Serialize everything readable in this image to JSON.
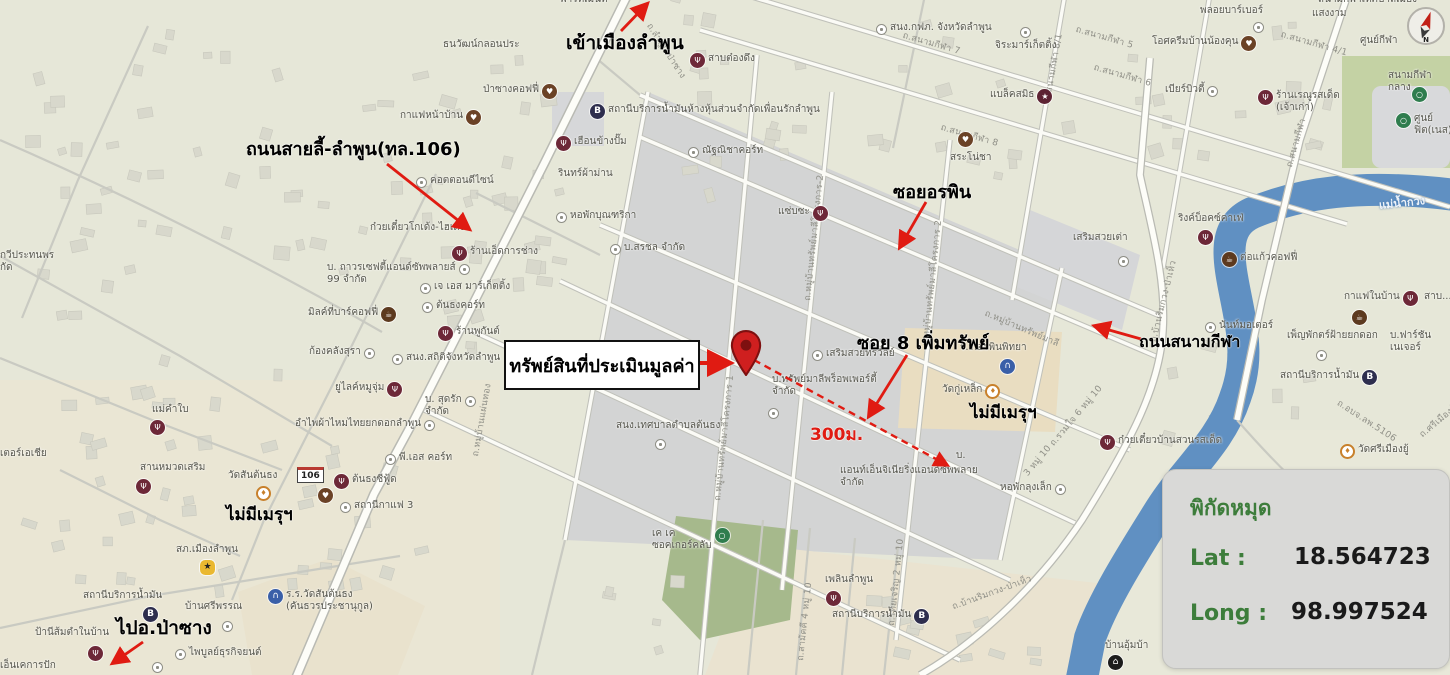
{
  "panel": {
    "title": "พิกัดหมุด",
    "lat_label": "Lat :",
    "lat_value": "18.564723",
    "long_label": "Long :",
    "long_value": "98.997524"
  },
  "property_box": {
    "label": "ทรัพย์สินที่ประเมินมูลค่า"
  },
  "colors": {
    "annotation_red": "#e01b12",
    "panel_green": "#3d7d3b",
    "pin_red": "#cf1f1f",
    "river_blue": "#6090c2"
  },
  "map": {
    "shield": {
      "t": "106"
    },
    "river_label": {
      "t": "แม่น้ำกวง",
      "x": 1378,
      "y": 196,
      "r": -6
    },
    "compass_label": "N",
    "pin": {
      "x": 746,
      "y": 375
    },
    "annotations": [
      {
        "t": "เข้าเมืองลำพูน",
        "x": 566,
        "y": 28,
        "s": 19
      },
      {
        "t": "ถนนสายลี้-ลำพูน(ทล.106)",
        "x": 246,
        "y": 134,
        "s": 18
      },
      {
        "t": "ซอยอรพิน",
        "x": 893,
        "y": 177,
        "s": 18
      },
      {
        "t": "ซอย 8 เพิ่มทรัพย์",
        "x": 857,
        "y": 328,
        "s": 18
      },
      {
        "t": "ไม่มีเมรุฯ",
        "x": 970,
        "y": 399,
        "s": 17
      },
      {
        "t": "ถนนสนามกีฬา",
        "x": 1139,
        "y": 330,
        "s": 16
      },
      {
        "t": "ไม่มีเมรุฯ",
        "x": 226,
        "y": 501,
        "s": 17
      },
      {
        "t": "ไปอ.ป่าซาง",
        "x": 116,
        "y": 613,
        "s": 19
      },
      {
        "t": "300ม.",
        "x": 810,
        "y": 421,
        "s": 17,
        "c": "#e01b12"
      }
    ],
    "arrows": [
      {
        "x1": 696,
        "y1": 363,
        "x2": 729,
        "y2": 363,
        "w": 4
      },
      {
        "x1": 754,
        "y1": 360,
        "x2": 947,
        "y2": 465,
        "w": 2.4,
        "dash": "7 5"
      },
      {
        "x1": 907,
        "y1": 355,
        "x2": 869,
        "y2": 416,
        "w": 2.8
      },
      {
        "x1": 926,
        "y1": 202,
        "x2": 900,
        "y2": 247,
        "w": 2.8
      },
      {
        "x1": 621,
        "y1": 31,
        "x2": 647,
        "y2": 4,
        "w": 2.8
      },
      {
        "x1": 387,
        "y1": 164,
        "x2": 469,
        "y2": 229,
        "w": 2.8
      },
      {
        "x1": 1141,
        "y1": 339,
        "x2": 1095,
        "y2": 326,
        "w": 2.8
      },
      {
        "x1": 143,
        "y1": 642,
        "x2": 113,
        "y2": 663,
        "w": 2.8
      }
    ],
    "road_labels": [
      {
        "t": "ถ.ลำพูน-ป่าซาง",
        "x": 655,
        "y": 20,
        "r": 57
      },
      {
        "t": "ถ.สนามกีฬา 7",
        "x": 905,
        "y": 28,
        "r": 16
      },
      {
        "t": "ถ.สนามกีฬา 5",
        "x": 1078,
        "y": 22,
        "r": 16
      },
      {
        "t": "ถ.สนามกีฬา 6",
        "x": 1096,
        "y": 60,
        "r": 16
      },
      {
        "t": "ถ.สนามกีฬา 8",
        "x": 943,
        "y": 120,
        "r": 16
      },
      {
        "t": "ถ.สนามกีฬา 8/1",
        "x": 1040,
        "y": 100,
        "r": -80
      },
      {
        "t": "ถ.สนามกีฬา 4/1",
        "x": 1283,
        "y": 27,
        "r": 16
      },
      {
        "t": "ถ.สนามกีฬา",
        "x": 1282,
        "y": 165,
        "r": -74
      },
      {
        "t": "ถ.หมู่บ้านทรัพย์มาลีโครงการ-2",
        "x": 800,
        "y": 300,
        "r": -84
      },
      {
        "t": "ถ.หมู่บ้านทรัพย์มาลีโครงการ 2",
        "x": 918,
        "y": 345,
        "r": -84
      },
      {
        "t": "ถ.หมู่บ้านทรัพย์มาลีโครงการ 1",
        "x": 710,
        "y": 500,
        "r": -84
      },
      {
        "t": "ถ.หมู่บ้านทรัพย์มาลี",
        "x": 988,
        "y": 306,
        "r": 23
      },
      {
        "t": "ถ.หมู่บ้านแผ่นทอง",
        "x": 468,
        "y": 455,
        "r": -80
      },
      {
        "t": "ถ.บ้านริมกวง-ป่าเห็ว",
        "x": 1146,
        "y": 340,
        "r": -76
      },
      {
        "t": "ถ.บ้านริมกวง-ป่าเห็ว",
        "x": 950,
        "y": 600,
        "r": -20
      },
      {
        "t": "ถ.รวมใจ 6 หมู่ 10",
        "x": 1046,
        "y": 440,
        "r": -50
      },
      {
        "t": "3 หมู่ 10",
        "x": 1020,
        "y": 470,
        "r": -50
      },
      {
        "t": "ถ.อบจ.ลพ.5106",
        "x": 1342,
        "y": 396,
        "r": 33
      },
      {
        "t": "ถ.สามัคคี 4 หมู่ 10",
        "x": 793,
        "y": 660,
        "r": -84
      },
      {
        "t": "ถ.ไทยเจริญ 2 หมู่ 10",
        "x": 884,
        "y": 625,
        "r": -84
      },
      {
        "t": "ถ.ศรีเมืองยู้ 2",
        "x": 1416,
        "y": 430,
        "r": -40
      }
    ],
    "pois": [
      {
        "t": "พาร์ทเมนท์",
        "x": 560,
        "y": -6
      },
      {
        "t": "สนง.กฟภ. จังหวัดลำพูน",
        "x": 876,
        "y": 22,
        "i": "generic"
      },
      {
        "t": "ธนวัฒน์กลอนประ",
        "x": 443,
        "y": 39
      },
      {
        "t": "สาบต๋องดึง",
        "x": 690,
        "y": 53,
        "i": "restaurant"
      },
      {
        "t": "ป่าซางคอฟฟี่",
        "x": 483,
        "y": 84,
        "i": "cafe",
        "ir": 1
      },
      {
        "t": "กาแฟหน้าบ้าน",
        "x": 400,
        "y": 110,
        "i": "cafe",
        "ir": 1
      },
      {
        "t": "สถานีบริการน้ำมันห้างหุ้นส่วนจำกัดเพื่อนรักลำพูน",
        "x": 590,
        "y": 104,
        "i": "fuel"
      },
      {
        "t": "เฮือนข้างปั๊ม",
        "x": 556,
        "y": 136,
        "i": "restaurant"
      },
      {
        "t": "ณัฐณิชาคอร์ท",
        "x": 688,
        "y": 145,
        "i": "generic"
      },
      {
        "t": "รินทร์ผ้าม่าน",
        "x": 558,
        "y": 168
      },
      {
        "t": "คอตตอนดีไซน์",
        "x": 416,
        "y": 175,
        "i": "generic"
      },
      {
        "t": "หอพักบุณฑริกา",
        "x": 556,
        "y": 210,
        "i": "generic"
      },
      {
        "t": "แซ่บซะ",
        "x": 778,
        "y": 206,
        "i": "restaurant",
        "ir": 1
      },
      {
        "t": "ก๋วยเตี๋ยวโกเด้ง-ไฮเด้ง",
        "x": 370,
        "y": 222
      },
      {
        "t": "ร้านเอ็ดการช่าง",
        "x": 452,
        "y": 246,
        "i": "restaurant"
      },
      {
        "t": "บ. ถาวรเซฟตี้แอนด์ซัพพลายส์\n99 จำกัด",
        "x": 327,
        "y": 262,
        "i": "generic",
        "ir": 1
      },
      {
        "t": "เจ เอส มาร์เก็ตติ้ง",
        "x": 420,
        "y": 281,
        "i": "generic"
      },
      {
        "t": "ต้นธงคอร์ท",
        "x": 422,
        "y": 300,
        "i": "generic"
      },
      {
        "t": "มิลค์ที่บาร์คอฟฟี่",
        "x": 308,
        "y": 307,
        "i": "coffee",
        "ir": 1
      },
      {
        "t": "ก้องคลังสุรา",
        "x": 309,
        "y": 346,
        "i": "generic",
        "ir": 1
      },
      {
        "t": "ร้านพูกันต์",
        "x": 438,
        "y": 326,
        "i": "restaurant"
      },
      {
        "t": "สนง.สถิติจังหวัดลำพูน",
        "x": 392,
        "y": 352,
        "i": "generic"
      },
      {
        "t": "บ.สรชล จำกัด",
        "x": 610,
        "y": 242,
        "i": "generic"
      },
      {
        "t": "ยูไลค์หมูจุ่ม",
        "x": 335,
        "y": 382,
        "i": "restaurant",
        "ir": 1
      },
      {
        "t": "บ. สุดรัก\nจำกัด",
        "x": 425,
        "y": 394,
        "i": "generic",
        "ir": 1
      },
      {
        "t": "อำไพผ้าไหมไทยยกดอกลำพูน",
        "x": 295,
        "y": 418,
        "i": "generic",
        "ir": 1
      },
      {
        "t": "แม่คำใบ",
        "x": 152,
        "y": 404
      },
      {
        "t": "",
        "x": 150,
        "y": 420,
        "i": "restaurant"
      },
      {
        "t": "พี.เอส คอร์ท",
        "x": 385,
        "y": 452,
        "i": "generic"
      },
      {
        "t": "ต้นธงซีฟู้ด",
        "x": 334,
        "y": 474,
        "i": "restaurant"
      },
      {
        "t": "",
        "x": 318,
        "y": 488,
        "i": "cafe"
      },
      {
        "t": "สถานีกาแฟ 3",
        "x": 340,
        "y": 500,
        "i": "generic"
      },
      {
        "t": "สานหมวดเสริม",
        "x": 140,
        "y": 462
      },
      {
        "t": "",
        "x": 136,
        "y": 479,
        "i": "restaurant"
      },
      {
        "t": "วัดสันต้นธง",
        "x": 228,
        "y": 470
      },
      {
        "t": "",
        "x": 256,
        "y": 486,
        "i": "temple"
      },
      {
        "t": "สภ.เมืองลำพูน",
        "x": 176,
        "y": 544
      },
      {
        "t": "",
        "x": 200,
        "y": 560,
        "i": "police"
      },
      {
        "t": "สถานีบริการน้ำมัน",
        "x": 83,
        "y": 590
      },
      {
        "t": "",
        "x": 143,
        "y": 607,
        "i": "fuel"
      },
      {
        "t": "บ้านศรีพรรณ",
        "x": 185,
        "y": 601
      },
      {
        "t": "",
        "x": 222,
        "y": 619,
        "i": "generic"
      },
      {
        "t": "ร.ร.วัดสันต้นธง\n(คันธวรประชานุกูล)",
        "x": 268,
        "y": 589,
        "i": "school"
      },
      {
        "t": "ไพบูลย์ธุรกิจยนต์",
        "x": 175,
        "y": 647,
        "i": "generic"
      },
      {
        "t": "",
        "x": 152,
        "y": 660,
        "i": "generic"
      },
      {
        "t": "ป้านีส้มตำในบ้าน",
        "x": 35,
        "y": 627
      },
      {
        "t": "",
        "x": 88,
        "y": 646,
        "i": "restaurant"
      },
      {
        "t": "เอ็นเคการปัก",
        "x": 0,
        "y": 660
      },
      {
        "t": "เตอร์เอเชีย",
        "x": 0,
        "y": 448
      },
      {
        "t": "กวีประทนพร\nกัด",
        "x": 0,
        "y": 250
      },
      {
        "t": "จิระมาร์เก็ตติ้ง",
        "x": 995,
        "y": 40
      },
      {
        "t": "",
        "x": 1020,
        "y": 25,
        "i": "generic"
      },
      {
        "t": "แบล็คสมิธ",
        "x": 990,
        "y": 89,
        "i": "shop",
        "ir": 1
      },
      {
        "t": "สระโน่ชา",
        "x": 950,
        "y": 152
      },
      {
        "t": "",
        "x": 958,
        "y": 132,
        "i": "cafe"
      },
      {
        "t": "พลอยบาร์เบอร์",
        "x": 1200,
        "y": 5
      },
      {
        "t": "",
        "x": 1253,
        "y": 20,
        "i": "generic"
      },
      {
        "t": "โอศครีมบ้านน้องคุน",
        "x": 1152,
        "y": 36,
        "i": "cafe",
        "ir": 1
      },
      {
        "t": "เบียร์บิวตี้",
        "x": 1165,
        "y": 84,
        "i": "generic",
        "ir": 1
      },
      {
        "t": "ร้านเรณูรสเด็ด\n(เจ้าเก่า)",
        "x": 1258,
        "y": 90,
        "i": "restaurant"
      },
      {
        "t": "สนามกีฬาเทศบาลเมือง",
        "x": 1318,
        "y": -6
      },
      {
        "t": "แสงงาม",
        "x": 1312,
        "y": 8
      },
      {
        "t": "ศูนย์กีฬา",
        "x": 1360,
        "y": 35
      },
      {
        "t": "สนามกีฬากลาง",
        "x": 1388,
        "y": 70
      },
      {
        "t": "ศูนย์ฟิต(เนส)",
        "x": 1396,
        "y": 113,
        "i": "sport"
      },
      {
        "t": "",
        "x": 1412,
        "y": 87,
        "i": "sport"
      },
      {
        "t": "เสริมสวยเต่า",
        "x": 1073,
        "y": 232
      },
      {
        "t": "",
        "x": 1118,
        "y": 254,
        "i": "generic"
      },
      {
        "t": "ริงค์บ็อคซ์คาเฟ่",
        "x": 1178,
        "y": 213
      },
      {
        "t": "",
        "x": 1198,
        "y": 230,
        "i": "restaurant"
      },
      {
        "t": "ต่อแก้วคอฟฟี่",
        "x": 1222,
        "y": 252,
        "i": "coffee"
      },
      {
        "t": "นันท์มอเตอร์",
        "x": 1205,
        "y": 320,
        "i": "generic"
      },
      {
        "t": "กาแฟในบ้าน",
        "x": 1344,
        "y": 291,
        "i": "restaurant",
        "ir": 1
      },
      {
        "t": "",
        "x": 1352,
        "y": 310,
        "i": "coffee"
      },
      {
        "t": "สาบ...",
        "x": 1424,
        "y": 291
      },
      {
        "t": "เพ็ญพักตร์ฝ้ายยกดอก",
        "x": 1287,
        "y": 330
      },
      {
        "t": "",
        "x": 1316,
        "y": 348,
        "i": "generic"
      },
      {
        "t": "บ.ฟาร์ชันเนเจอร์",
        "x": 1390,
        "y": 330
      },
      {
        "t": "สถานีบริการน้ำมัน",
        "x": 1280,
        "y": 370,
        "i": "fuel",
        "ir": 1
      },
      {
        "t": "ก๋วยเตี๋ยวบ้านสวนรสเด็ด",
        "x": 1100,
        "y": 435,
        "i": "restaurant"
      },
      {
        "t": "วัดศรีเมืองยู้",
        "x": 1340,
        "y": 444,
        "i": "temple"
      },
      {
        "t": "หอพักลุงเล็ก",
        "x": 1000,
        "y": 482,
        "i": "generic",
        "ir": 1
      },
      {
        "t": "บ้านอุ้มบ้า",
        "x": 1105,
        "y": 640
      },
      {
        "t": "",
        "x": 1108,
        "y": 655,
        "i": "lodging"
      },
      {
        "t": "ร.ร.อรพินพิทยา",
        "x": 960,
        "y": 342
      },
      {
        "t": "",
        "x": 1000,
        "y": 359,
        "i": "school"
      },
      {
        "t": "วัดกู่เหล็ก",
        "x": 942,
        "y": 384,
        "i": "temple",
        "ir": 1
      },
      {
        "t": "เสริมสวยทรวัลย์",
        "x": 812,
        "y": 348,
        "i": "generic"
      },
      {
        "t": "บ.ทรัพย์มาลีพร็อพเพอร์ตี้\nจำกัด",
        "x": 772,
        "y": 374
      },
      {
        "t": "",
        "x": 768,
        "y": 406,
        "i": "generic"
      },
      {
        "t": "สนง.เทศบาลตำบลต้นธง",
        "x": 616,
        "y": 420
      },
      {
        "t": "",
        "x": 655,
        "y": 437,
        "i": "generic"
      },
      {
        "t": "บ.",
        "x": 956,
        "y": 450
      },
      {
        "t": "แอนท์เอ็นจิเนียริ่งแอนด์ซัพพลาย\nจำกัด",
        "x": 840,
        "y": 465
      },
      {
        "t": "เพลินลำพูน",
        "x": 825,
        "y": 574
      },
      {
        "t": "",
        "x": 826,
        "y": 591,
        "i": "restaurant"
      },
      {
        "t": "สถานีบริการน้ำมัน",
        "x": 832,
        "y": 609,
        "i": "fuel",
        "ir": 1
      },
      {
        "t": "เค เค\nซอคเกอร์คลับ",
        "x": 652,
        "y": 528,
        "i": "sport",
        "ir": 1
      }
    ]
  }
}
